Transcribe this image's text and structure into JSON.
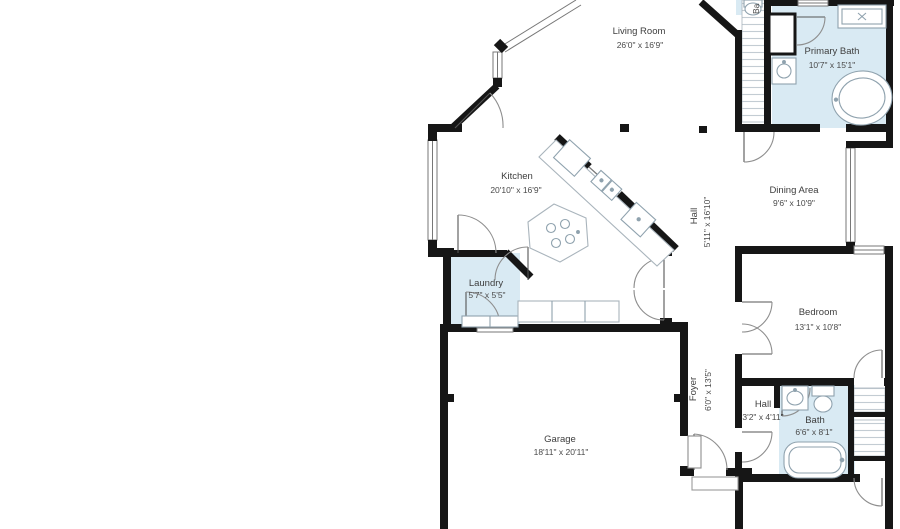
{
  "colors": {
    "wall": "#161616",
    "wet_fill": "#d9eaf3",
    "fixture_stroke": "#8fa2ae",
    "thin_line": "#6f6f6f",
    "hatch": "#c3ccd3",
    "text": "#3e3e3e"
  },
  "rooms": {
    "living_room": {
      "name": "Living Room",
      "dims": "26'0\" x 16'9\""
    },
    "primary_bath": {
      "name": "Primary Bath",
      "dims": "10'7\" x 15'1\""
    },
    "kitchen": {
      "name": "Kitchen",
      "dims": "20'10\" x 16'9\""
    },
    "dining_area": {
      "name": "Dining Area",
      "dims": "9'6\" x 10'9\""
    },
    "hall_upper": {
      "name": "Hall",
      "dims": "5'11\" x 16'10\""
    },
    "laundry": {
      "name": "Laundry",
      "dims": "5'7\" x 5'5\""
    },
    "bedroom": {
      "name": "Bedroom",
      "dims": "13'1\" x 10'8\""
    },
    "foyer": {
      "name": "Foyer",
      "dims": "6'0\" x 13'5\""
    },
    "hall_lower": {
      "name": "Hall",
      "dims": "3'2\" x 4'11\""
    },
    "bath": {
      "name": "Bath",
      "dims": "6'6\" x 8'1\""
    },
    "garage": {
      "name": "Garage",
      "dims": "18'11\" x 20'11\""
    },
    "clipped_top": {
      "name": "Ba"
    }
  }
}
